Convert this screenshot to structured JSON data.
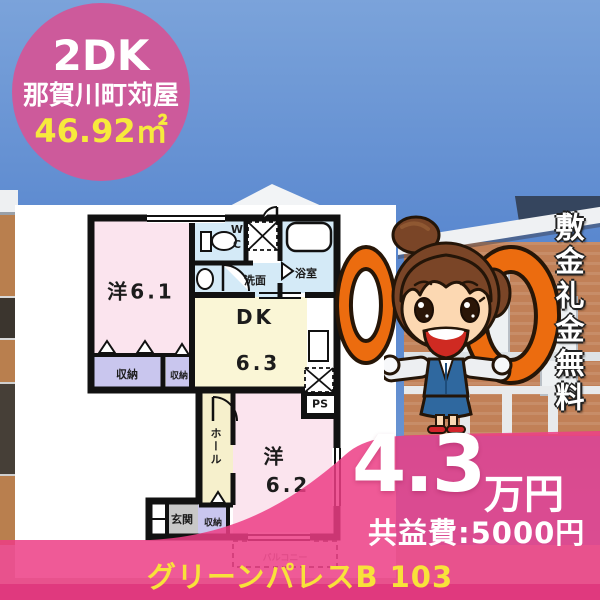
{
  "badge": {
    "layout_type": "2DK",
    "location": "那賀川町苅屋",
    "area": "46.92㎡"
  },
  "floorplan": {
    "rooms": [
      {
        "label": "洋6.1"
      },
      {
        "label": "収納"
      },
      {
        "label": "収納"
      },
      {
        "label": "WC"
      },
      {
        "label": "洗面"
      },
      {
        "label": "浴室"
      },
      {
        "label": "DK"
      },
      {
        "label": "6.3"
      },
      {
        "label": "PS"
      },
      {
        "label": "ホール"
      },
      {
        "label": "洋"
      },
      {
        "label": "6.2"
      },
      {
        "label": "収納"
      },
      {
        "label": "玄関"
      },
      {
        "label": "バルコニー"
      }
    ]
  },
  "promo": {
    "zero_left": "0",
    "zero_right": "0",
    "vertical_text": "敷金礼金無料"
  },
  "price": {
    "rent_value": "4.3",
    "rent_unit": "万円",
    "fee": "共益費:5000円"
  },
  "footer": {
    "property_name": "グリーンパレスB 103"
  },
  "colors": {
    "badge_pink": "#cd5a9b",
    "overlay_pink": "#ec3d85",
    "zero_orange": "#ec6c0f",
    "accent_yellow": "#f8e23a",
    "room_pink": "#fbe4ee",
    "room_yellow": "#faf6d6",
    "room_blue": "#d4eaf7",
    "closet_lavender": "#c9c6ee",
    "entrance_gray": "#c8c8c8"
  }
}
